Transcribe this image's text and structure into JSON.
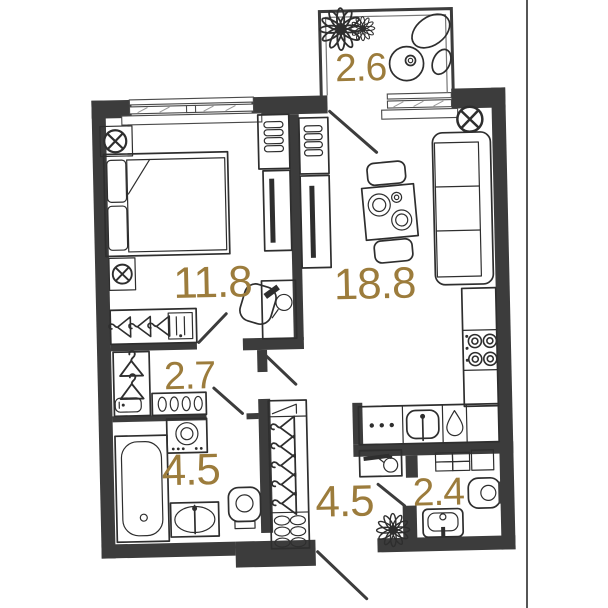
{
  "plan": {
    "colors": {
      "accent": "#9c7c3c",
      "wall": "#3c3c3c",
      "line": "#2e2e2e",
      "background": "#ffffff"
    },
    "rooms": [
      {
        "id": "balcony",
        "area": "2.6"
      },
      {
        "id": "bedroom",
        "area": "11.8"
      },
      {
        "id": "living-kitchen",
        "area": "18.8"
      },
      {
        "id": "wardrobe",
        "area": "2.7"
      },
      {
        "id": "bathroom",
        "area": "4.5"
      },
      {
        "id": "hallway",
        "area": "4.5"
      },
      {
        "id": "wc",
        "area": "2.4"
      }
    ],
    "icons": {
      "ceiling-light-icon": "circle with X cross",
      "flower-icon": "petal rosette",
      "plant-icon": "petal rosette",
      "hanger-icon": "clothes hanger",
      "kettle-icon": "kettle on shelf",
      "water-drop-icon": "drop outline",
      "stove-burner-icon": "double circle"
    }
  }
}
